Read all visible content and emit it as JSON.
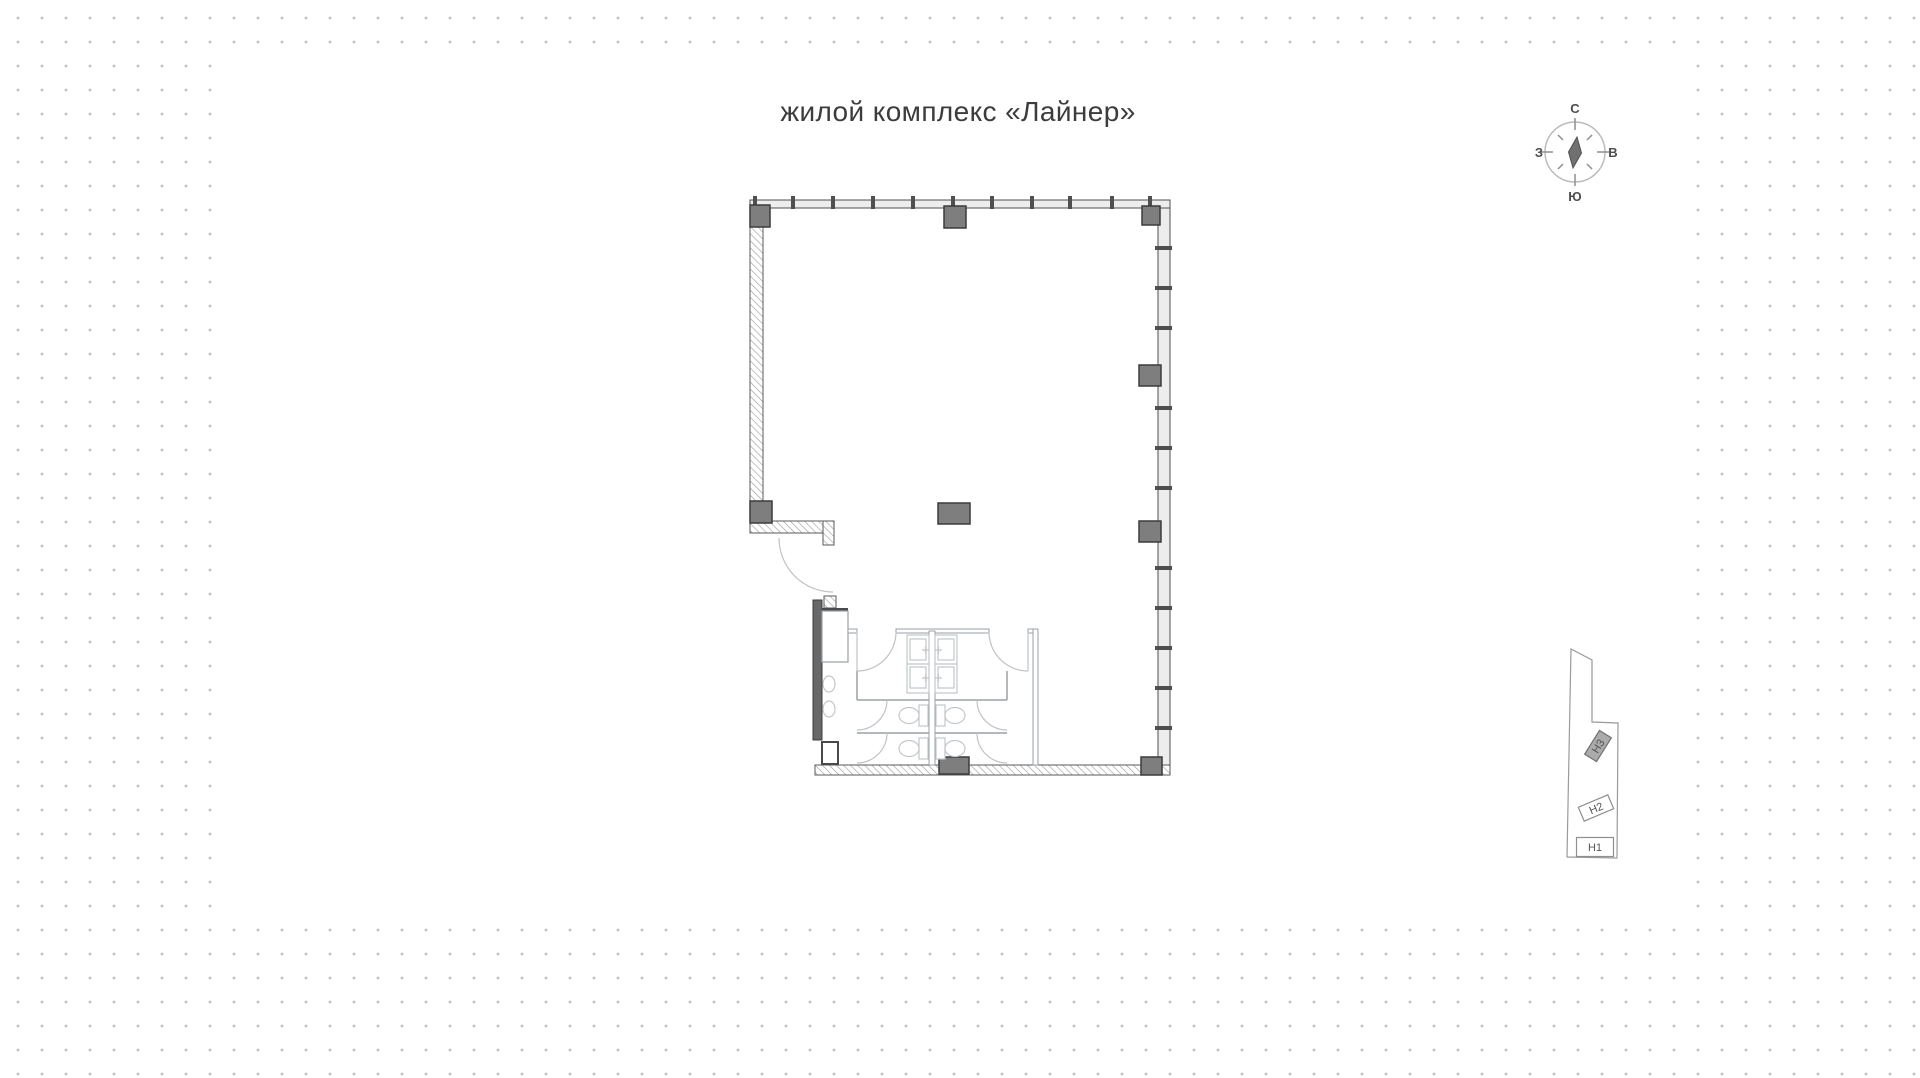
{
  "title": "жилой комплекс «Лайнер»",
  "compass": {
    "labels": {
      "north": "С",
      "east": "В",
      "south": "Ю",
      "west": "З"
    }
  },
  "key_plan": {
    "units": [
      {
        "label": "Н3",
        "highlighted": true
      },
      {
        "label": "Н2",
        "highlighted": false
      },
      {
        "label": "Н1",
        "highlighted": false
      }
    ]
  },
  "colors": {
    "column_fill": "#7e7e7e",
    "column_stroke": "#3c3c3c",
    "window_wall_fill": "#ededed",
    "wall_stroke": "#555555",
    "highlight_fill": "#ababab",
    "dot": "#c5c5c5"
  }
}
